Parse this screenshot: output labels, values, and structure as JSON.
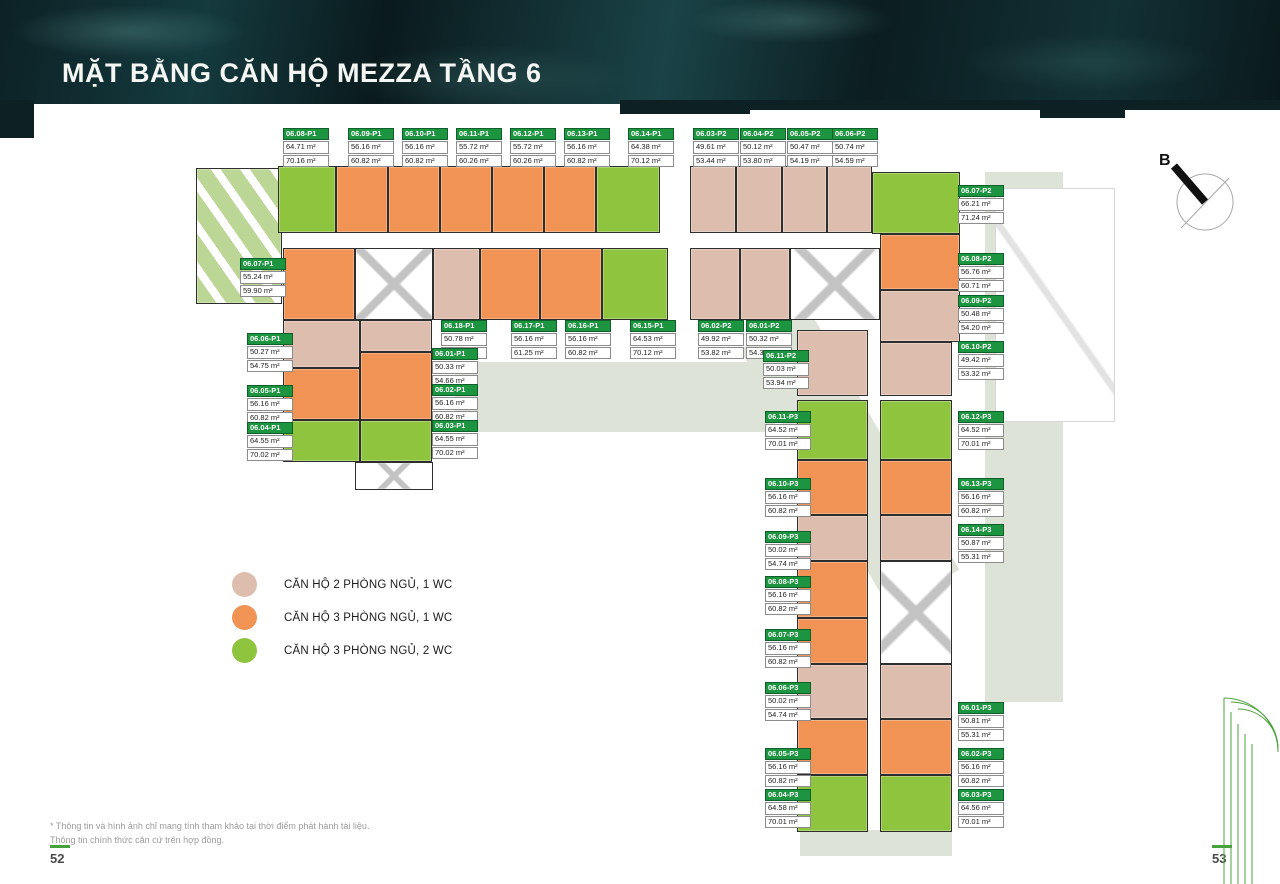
{
  "header": {
    "title": "MẶT BẰNG CĂN HỘ MEZZA TẦNG 6"
  },
  "compass": {
    "label": "B"
  },
  "colors": {
    "accent_green": "#1d9440",
    "unit_2br": "#ddbeae",
    "unit_3br_1wc": "#f09354",
    "unit_3br_2wc": "#8fc43f",
    "marble_dark": "#0d2125",
    "page_dash": "#46a33c"
  },
  "legend": {
    "items": [
      {
        "color": "#ddbeae",
        "label": "CĂN HỘ 2 PHÒNG NGỦ, 1 WC"
      },
      {
        "color": "#f09354",
        "label": "CĂN HỘ 3 PHÒNG NGỦ, 1 WC"
      },
      {
        "color": "#8fc43f",
        "label": "CĂN HỘ 3 PHÒNG NGỦ, 2 WC"
      }
    ]
  },
  "footer": {
    "note1": "* Thông tin và hình ảnh chỉ mang tính tham khảo tại thời điểm phát hành tài liệu.",
    "note2": "Thông tin chính thức căn cứ trên hợp đồng.",
    "page_left": "52",
    "page_right": "53"
  },
  "plan": {
    "units": [
      {
        "code": "06.08-P1",
        "a1": "64.71 m²",
        "a2": "70.16 m²",
        "x": 283,
        "y": 128
      },
      {
        "code": "06.09-P1",
        "a1": "56.16 m²",
        "a2": "60.82 m²",
        "x": 348,
        "y": 128
      },
      {
        "code": "06.10-P1",
        "a1": "56.16 m²",
        "a2": "60.82 m²",
        "x": 402,
        "y": 128
      },
      {
        "code": "06.11-P1",
        "a1": "55.72 m²",
        "a2": "60.26 m²",
        "x": 456,
        "y": 128
      },
      {
        "code": "06.12-P1",
        "a1": "55.72 m²",
        "a2": "60.26 m²",
        "x": 510,
        "y": 128
      },
      {
        "code": "06.13-P1",
        "a1": "56.16 m²",
        "a2": "60.82 m²",
        "x": 564,
        "y": 128
      },
      {
        "code": "06.14-P1",
        "a1": "64.38 m²",
        "a2": "70.12 m²",
        "x": 628,
        "y": 128
      },
      {
        "code": "06.03-P2",
        "a1": "49.61 m²",
        "a2": "53.44 m²",
        "x": 693,
        "y": 128
      },
      {
        "code": "06.04-P2",
        "a1": "50.12 m²",
        "a2": "53.80 m²",
        "x": 740,
        "y": 128
      },
      {
        "code": "06.05-P2",
        "a1": "50.47 m²",
        "a2": "54.19 m²",
        "x": 787,
        "y": 128
      },
      {
        "code": "06.06-P2",
        "a1": "50.74 m²",
        "a2": "54.59 m²",
        "x": 832,
        "y": 128
      },
      {
        "code": "06.07-P2",
        "a1": "66.21 m²",
        "a2": "71.24 m²",
        "x": 958,
        "y": 185
      },
      {
        "code": "06.08-P2",
        "a1": "56.76 m²",
        "a2": "60.71 m²",
        "x": 958,
        "y": 253
      },
      {
        "code": "06.09-P2",
        "a1": "50.48 m²",
        "a2": "54.20 m²",
        "x": 958,
        "y": 295
      },
      {
        "code": "06.10-P2",
        "a1": "49.42 m²",
        "a2": "53.32 m²",
        "x": 958,
        "y": 341
      },
      {
        "code": "06.18-P1",
        "a1": "50.78 m²",
        "a2": "55.67 m²",
        "x": 441,
        "y": 320
      },
      {
        "code": "06.17-P1",
        "a1": "56.16 m²",
        "a2": "61.25 m²",
        "x": 511,
        "y": 320
      },
      {
        "code": "06.16-P1",
        "a1": "56.16 m²",
        "a2": "60.82 m²",
        "x": 565,
        "y": 320
      },
      {
        "code": "06.15-P1",
        "a1": "64.53 m²",
        "a2": "70.12 m²",
        "x": 630,
        "y": 320
      },
      {
        "code": "06.02-P2",
        "a1": "49.92 m²",
        "a2": "53.82 m²",
        "x": 698,
        "y": 320
      },
      {
        "code": "06.01-P2",
        "a1": "50.32 m²",
        "a2": "54.39 m²",
        "x": 746,
        "y": 320
      },
      {
        "code": "06.07-P1",
        "a1": "55.24 m²",
        "a2": "59.90 m²",
        "x": 240,
        "y": 258
      },
      {
        "code": "06.06-P1",
        "a1": "50.27 m²",
        "a2": "54.75 m²",
        "x": 247,
        "y": 333
      },
      {
        "code": "06.05-P1",
        "a1": "56.16 m²",
        "a2": "60.82 m²",
        "x": 247,
        "y": 385
      },
      {
        "code": "06.04-P1",
        "a1": "64.55 m²",
        "a2": "70.02 m²",
        "x": 247,
        "y": 422
      },
      {
        "code": "06.01-P1",
        "a1": "50.33 m²",
        "a2": "54.66 m²",
        "x": 432,
        "y": 348
      },
      {
        "code": "06.02-P1",
        "a1": "56.16 m²",
        "a2": "60.82 m²",
        "x": 432,
        "y": 384
      },
      {
        "code": "06.03-P1",
        "a1": "64.55 m²",
        "a2": "70.02 m²",
        "x": 432,
        "y": 420
      },
      {
        "code": "06.11-P2",
        "a1": "50.03 m²",
        "a2": "53.94 m²",
        "x": 763,
        "y": 350
      },
      {
        "code": "06.11-P3",
        "a1": "64.52 m²",
        "a2": "70.01 m²",
        "x": 765,
        "y": 411
      },
      {
        "code": "06.10-P3",
        "a1": "56.16 m²",
        "a2": "60.82 m²",
        "x": 765,
        "y": 478
      },
      {
        "code": "06.09-P3",
        "a1": "50.02 m²",
        "a2": "54.74 m²",
        "x": 765,
        "y": 531
      },
      {
        "code": "06.08-P3",
        "a1": "56.16 m²",
        "a2": "60.82 m²",
        "x": 765,
        "y": 576
      },
      {
        "code": "06.07-P3",
        "a1": "56.16 m²",
        "a2": "60.82 m²",
        "x": 765,
        "y": 629
      },
      {
        "code": "06.06-P3",
        "a1": "50.02 m²",
        "a2": "54.74 m²",
        "x": 765,
        "y": 682
      },
      {
        "code": "06.05-P3",
        "a1": "56.16 m²",
        "a2": "60.82 m²",
        "x": 765,
        "y": 748
      },
      {
        "code": "06.04-P3",
        "a1": "64.58 m²",
        "a2": "70.01 m²",
        "x": 765,
        "y": 789
      },
      {
        "code": "06.12-P3",
        "a1": "64.52 m²",
        "a2": "70.01 m²",
        "x": 958,
        "y": 411
      },
      {
        "code": "06.13-P3",
        "a1": "56.16 m²",
        "a2": "60.82 m²",
        "x": 958,
        "y": 478
      },
      {
        "code": "06.14-P3",
        "a1": "50.87 m²",
        "a2": "55.31 m²",
        "x": 958,
        "y": 524
      },
      {
        "code": "06.01-P3",
        "a1": "50.81 m²",
        "a2": "55.31 m²",
        "x": 958,
        "y": 702
      },
      {
        "code": "06.02-P3",
        "a1": "56.16 m²",
        "a2": "60.82 m²",
        "x": 958,
        "y": 748
      },
      {
        "code": "06.03-P3",
        "a1": "64.56 m²",
        "a2": "70.01 m²",
        "x": 958,
        "y": 789
      }
    ],
    "blocks": [
      {
        "x": 196,
        "y": 168,
        "w": 86,
        "h": 136,
        "c": "t"
      },
      {
        "x": 278,
        "y": 166,
        "w": 58,
        "h": 67,
        "c": "g"
      },
      {
        "x": 336,
        "y": 166,
        "w": 52,
        "h": 67,
        "c": "o"
      },
      {
        "x": 388,
        "y": 166,
        "w": 52,
        "h": 67,
        "c": "o"
      },
      {
        "x": 440,
        "y": 166,
        "w": 52,
        "h": 67,
        "c": "o"
      },
      {
        "x": 492,
        "y": 166,
        "w": 52,
        "h": 67,
        "c": "o"
      },
      {
        "x": 544,
        "y": 166,
        "w": 52,
        "h": 67,
        "c": "o"
      },
      {
        "x": 596,
        "y": 166,
        "w": 64,
        "h": 67,
        "c": "g"
      },
      {
        "x": 283,
        "y": 248,
        "w": 72,
        "h": 72,
        "c": "o"
      },
      {
        "x": 355,
        "y": 248,
        "w": 78,
        "h": 72,
        "c": "w"
      },
      {
        "x": 433,
        "y": 248,
        "w": 47,
        "h": 72,
        "c": "p"
      },
      {
        "x": 480,
        "y": 248,
        "w": 60,
        "h": 72,
        "c": "o"
      },
      {
        "x": 540,
        "y": 248,
        "w": 62,
        "h": 72,
        "c": "o"
      },
      {
        "x": 602,
        "y": 248,
        "w": 66,
        "h": 72,
        "c": "g"
      },
      {
        "x": 690,
        "y": 166,
        "w": 46,
        "h": 67,
        "c": "p"
      },
      {
        "x": 736,
        "y": 166,
        "w": 46,
        "h": 67,
        "c": "p"
      },
      {
        "x": 782,
        "y": 166,
        "w": 45,
        "h": 67,
        "c": "p"
      },
      {
        "x": 827,
        "y": 166,
        "w": 45,
        "h": 67,
        "c": "p"
      },
      {
        "x": 872,
        "y": 172,
        "w": 88,
        "h": 62,
        "c": "g"
      },
      {
        "x": 690,
        "y": 248,
        "w": 50,
        "h": 72,
        "c": "p"
      },
      {
        "x": 740,
        "y": 248,
        "w": 50,
        "h": 72,
        "c": "p"
      },
      {
        "x": 790,
        "y": 248,
        "w": 90,
        "h": 72,
        "c": "w"
      },
      {
        "x": 880,
        "y": 234,
        "w": 80,
        "h": 56,
        "c": "o"
      },
      {
        "x": 880,
        "y": 290,
        "w": 80,
        "h": 52,
        "c": "p"
      },
      {
        "x": 880,
        "y": 342,
        "w": 72,
        "h": 54,
        "c": "p"
      },
      {
        "x": 797,
        "y": 330,
        "w": 71,
        "h": 66,
        "c": "p"
      },
      {
        "x": 797,
        "y": 400,
        "w": 71,
        "h": 60,
        "c": "g"
      },
      {
        "x": 880,
        "y": 400,
        "w": 72,
        "h": 60,
        "c": "g"
      },
      {
        "x": 797,
        "y": 460,
        "w": 71,
        "h": 55,
        "c": "o"
      },
      {
        "x": 880,
        "y": 460,
        "w": 72,
        "h": 55,
        "c": "o"
      },
      {
        "x": 797,
        "y": 515,
        "w": 71,
        "h": 46,
        "c": "p"
      },
      {
        "x": 880,
        "y": 515,
        "w": 72,
        "h": 46,
        "c": "p"
      },
      {
        "x": 797,
        "y": 561,
        "w": 71,
        "h": 57,
        "c": "o"
      },
      {
        "x": 880,
        "y": 561,
        "w": 72,
        "h": 103,
        "c": "w"
      },
      {
        "x": 797,
        "y": 618,
        "w": 71,
        "h": 46,
        "c": "o"
      },
      {
        "x": 797,
        "y": 664,
        "w": 71,
        "h": 55,
        "c": "p"
      },
      {
        "x": 880,
        "y": 664,
        "w": 72,
        "h": 55,
        "c": "p"
      },
      {
        "x": 797,
        "y": 719,
        "w": 71,
        "h": 56,
        "c": "o"
      },
      {
        "x": 880,
        "y": 719,
        "w": 72,
        "h": 56,
        "c": "o"
      },
      {
        "x": 797,
        "y": 775,
        "w": 71,
        "h": 57,
        "c": "g"
      },
      {
        "x": 880,
        "y": 775,
        "w": 72,
        "h": 57,
        "c": "g"
      },
      {
        "x": 283,
        "y": 320,
        "w": 77,
        "h": 48,
        "c": "p"
      },
      {
        "x": 283,
        "y": 368,
        "w": 77,
        "h": 52,
        "c": "o"
      },
      {
        "x": 283,
        "y": 420,
        "w": 77,
        "h": 42,
        "c": "g"
      },
      {
        "x": 360,
        "y": 320,
        "w": 72,
        "h": 32,
        "c": "p"
      },
      {
        "x": 360,
        "y": 352,
        "w": 72,
        "h": 68,
        "c": "o"
      },
      {
        "x": 360,
        "y": 420,
        "w": 72,
        "h": 42,
        "c": "g"
      },
      {
        "x": 355,
        "y": 462,
        "w": 78,
        "h": 28,
        "c": "w"
      }
    ]
  }
}
